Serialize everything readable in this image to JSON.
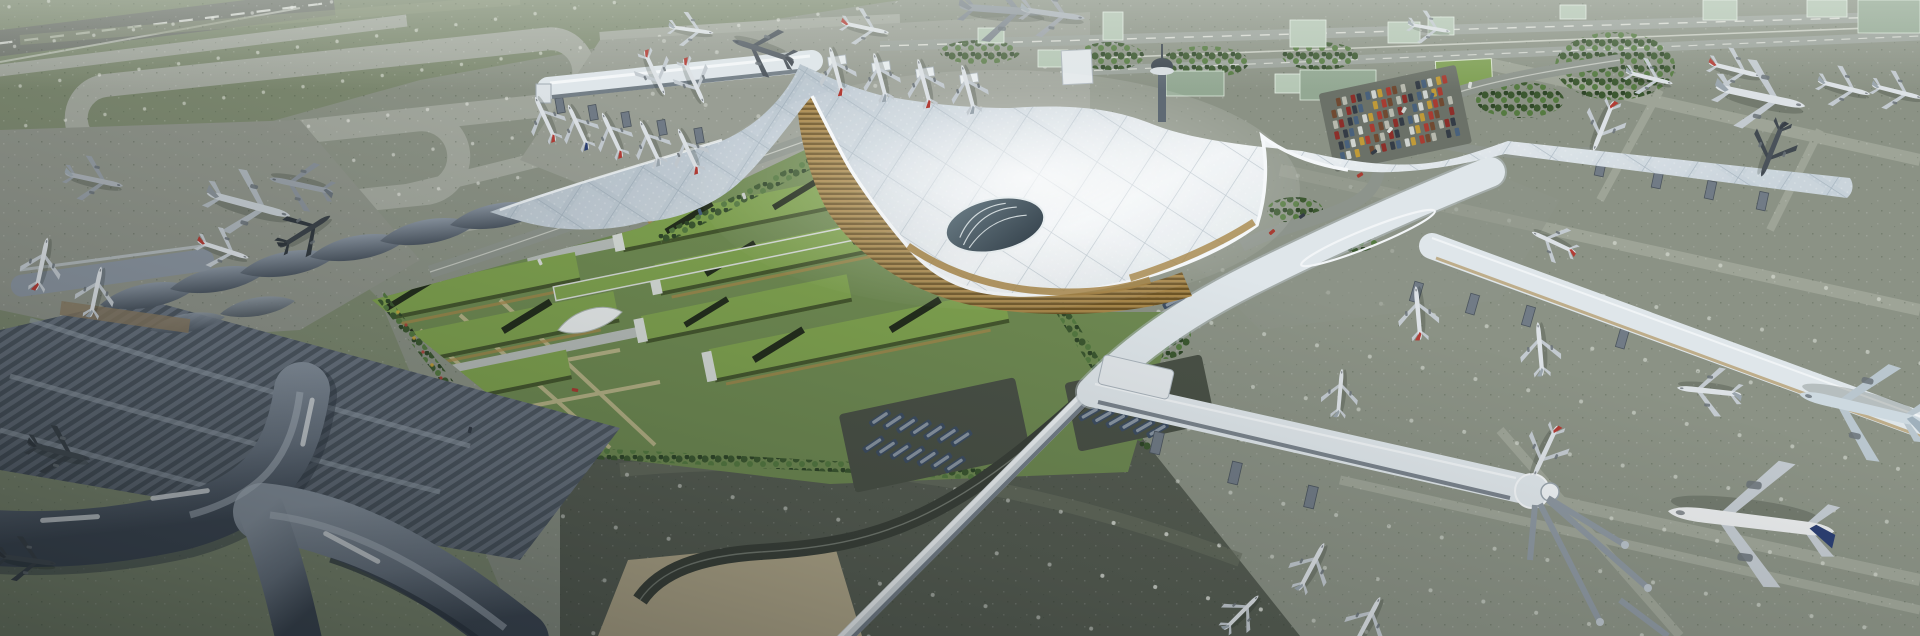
{
  "scene": {
    "subject": "aerial-render-airport-terminal-complex",
    "elements": [
      "main-terminal-gridshell-roof",
      "green-roof-district",
      "legacy-terminal-wave-halls",
      "satellite-x-pier",
      "north-concourse",
      "east-piers",
      "taxiway-loops",
      "runway",
      "landside-highway",
      "parking-lot",
      "control-tower",
      "airplanes",
      "buses",
      "cars",
      "tree-belts",
      "glass-buildings"
    ]
  },
  "colors": {
    "grass": "#7d8970",
    "grassLight": "#8b9679",
    "grassDark": "#6c785f",
    "taxiway": "#a3a89e",
    "runway": "#6f746c",
    "apronNW": "#999e94",
    "apronW": "#8f948a",
    "apronE": "#8d9387",
    "apronS": "#565d52",
    "roofHi": "#eef2f4",
    "roofMid": "#c5d0d8",
    "roofLo": "#9fadb9",
    "ribbon": "#dfe6ea",
    "spine": "#aeb9c1",
    "facadeDark": "#616c76",
    "gold": "#a8874a",
    "goldDark": "#6e5526",
    "glassCanyon": "#33404a",
    "greenRoof": "#7fa24f",
    "greenRoofDk": "#5b7737",
    "skylight": "#232d1c",
    "endcap": "#d6dbd7",
    "lawn": "#6f8a52",
    "lawnPath": "#c2b98f",
    "tree": "#3c5830",
    "treeLight": "#557a41",
    "shedHi": "#9aa5b1",
    "shedMid": "#6b7683",
    "shedLo": "#4d5762",
    "xpier": "#7e8894",
    "xpierDk": "#39424e",
    "plaza": "#b2a88a",
    "roadDark": "#3b4139",
    "roadMid": "#8d948c",
    "glassBldg": "#b5c7b5",
    "glassBldgSide": "#93a893",
    "pitch": "#7fa054",
    "towerBody": "#5f6a74",
    "planeBody": "#dde2e6",
    "planeWing": "#c3cad0",
    "tailRed": "#b23c35",
    "tailBlue": "#2c3f72",
    "bus": "#3e4e62",
    "busLight": "#93a0ac",
    "lightDot": "#f2f5ef",
    "white": "#f4f7f9",
    "shadow": "#0a1014"
  },
  "planes": [
    {
      "x": 250,
      "y": 205,
      "r": 15,
      "s": 0.8,
      "b": "#c6cdd2",
      "w": "#aeb6bc",
      "t": "#8a9298"
    },
    {
      "x": 306,
      "y": 231,
      "r": -32,
      "s": 0.55,
      "b": "#3c4349",
      "w": "#333a40",
      "t": "#30373d"
    },
    {
      "x": 224,
      "y": 250,
      "r": 18,
      "s": 0.5,
      "t": "#b23c35"
    },
    {
      "x": 42,
      "y": 263,
      "r": -78,
      "s": 0.5,
      "t": "#b23c35"
    },
    {
      "x": 96,
      "y": 291,
      "r": -78,
      "s": 0.48
    },
    {
      "x": 95,
      "y": 180,
      "r": 12,
      "s": 0.55,
      "b": "#aab1b7",
      "w": "#959da4"
    },
    {
      "x": 300,
      "y": 185,
      "r": 192,
      "s": 0.6,
      "b": "#9aa2a9",
      "w": "#8a929a",
      "t": "#6a737b"
    },
    {
      "x": 60,
      "y": 452,
      "r": 14,
      "s": 0.6,
      "b": "#454d54",
      "w": "#3c444b",
      "t": "#343b42"
    },
    {
      "x": 28,
      "y": 560,
      "r": 8,
      "s": 0.55,
      "b": "#454d54",
      "w": "#3c444b",
      "t": "#343b42"
    },
    {
      "x": 545,
      "y": 118,
      "r": -115,
      "s": 0.45,
      "t": "#b23c35"
    },
    {
      "x": 578,
      "y": 126,
      "r": -115,
      "s": 0.45,
      "t": "#2c3f72"
    },
    {
      "x": 612,
      "y": 134,
      "r": -115,
      "s": 0.45,
      "t": "#b23c35"
    },
    {
      "x": 650,
      "y": 142,
      "r": -115,
      "s": 0.45
    },
    {
      "x": 688,
      "y": 150,
      "r": -115,
      "s": 0.45,
      "t": "#b23c35"
    },
    {
      "x": 655,
      "y": 74,
      "r": 65,
      "s": 0.45,
      "t": "#b23c35"
    },
    {
      "x": 694,
      "y": 82,
      "r": 65,
      "s": 0.45,
      "t": "#b23c35"
    },
    {
      "x": 836,
      "y": 70,
      "r": -105,
      "s": 0.46,
      "t": "#b23c35"
    },
    {
      "x": 880,
      "y": 76,
      "r": -105,
      "s": 0.46
    },
    {
      "x": 924,
      "y": 82,
      "r": -105,
      "s": 0.46,
      "t": "#b23c35"
    },
    {
      "x": 968,
      "y": 88,
      "r": -105,
      "s": 0.46
    },
    {
      "x": 692,
      "y": 30,
      "r": 8,
      "s": 0.42
    },
    {
      "x": 762,
      "y": 50,
      "r": 198,
      "s": 0.6,
      "b": "#565e66",
      "w": "#4c545c",
      "t": "#454c54"
    },
    {
      "x": 866,
      "y": 28,
      "r": 12,
      "s": 0.45,
      "t": "#b23c35"
    },
    {
      "x": 1004,
      "y": 10,
      "r": 4,
      "s": 0.8,
      "b": "#8d959c",
      "w": "#7d858d",
      "t": "#767e86"
    },
    {
      "x": 1054,
      "y": 14,
      "r": 8,
      "s": 0.6,
      "b": "#aab1b8",
      "w": "#999fa6"
    },
    {
      "x": 1430,
      "y": 28,
      "r": 10,
      "s": 0.4
    },
    {
      "x": 1650,
      "y": 78,
      "r": 14,
      "s": 0.45
    },
    {
      "x": 1736,
      "y": 70,
      "r": 14,
      "s": 0.5,
      "t": "#b23c35"
    },
    {
      "x": 1762,
      "y": 97,
      "r": 12,
      "s": 0.85
    },
    {
      "x": 1845,
      "y": 88,
      "r": 14,
      "s": 0.5
    },
    {
      "x": 1898,
      "y": 92,
      "r": 14,
      "s": 0.48
    },
    {
      "x": 1603,
      "y": 127,
      "r": 112,
      "s": 0.5,
      "t": "#b23c35"
    },
    {
      "x": 1772,
      "y": 150,
      "r": 112,
      "s": 0.55,
      "b": "#4a525a",
      "w": "#414950",
      "t": "#394048"
    },
    {
      "x": 1553,
      "y": 242,
      "r": 205,
      "s": 0.45,
      "t": "#b23c35"
    },
    {
      "x": 1418,
      "y": 312,
      "r": -95,
      "s": 0.5,
      "t": "#b23c35"
    },
    {
      "x": 1540,
      "y": 348,
      "r": -95,
      "s": 0.5
    },
    {
      "x": 1340,
      "y": 392,
      "r": -85,
      "s": 0.45
    },
    {
      "x": 1545,
      "y": 452,
      "r": 115,
      "s": 0.52,
      "t": "#b23c35"
    },
    {
      "x": 1312,
      "y": 566,
      "r": -62,
      "s": 0.5
    },
    {
      "x": 1368,
      "y": 620,
      "r": -62,
      "s": 0.5
    },
    {
      "x": 1242,
      "y": 612,
      "r": -45,
      "s": 0.45
    },
    {
      "x": 1748,
      "y": 521,
      "r": 187,
      "s": 1.55,
      "b": "#e9ebec",
      "t": "#2c3f72"
    },
    {
      "x": 1860,
      "y": 408,
      "r": 193,
      "s": 1.2,
      "b": "#cdd9e0",
      "w": "#b9c6ce",
      "t": "#9fb0bc"
    },
    {
      "x": 1708,
      "y": 391,
      "r": 186,
      "s": 0.6
    }
  ],
  "carpark": {
    "x": 1328,
    "y": 100,
    "rot": -12,
    "rows": 6,
    "cols": 17,
    "gx": 7.3,
    "gy": 10.8,
    "w": 4.6,
    "h": 8.2
  },
  "carColors": [
    "#a83c32",
    "#c09a38",
    "#cfd3cf",
    "#49617c",
    "#343c46",
    "#8c2f2a",
    "#b7b9ae",
    "#704a32"
  ],
  "busLots": [
    {
      "x": 880,
      "y": 418,
      "rowAng": 14,
      "busAng": -34,
      "n": 7,
      "rows": 2,
      "gap": 14,
      "dy": 27
    },
    {
      "x": 1096,
      "y": 388,
      "rowAng": 14,
      "busAng": -30,
      "n": 6,
      "rows": 2,
      "gap": 14,
      "dy": 26
    },
    {
      "x": 1136,
      "y": 292,
      "rowAng": 14,
      "busAng": -28,
      "n": 5,
      "rows": 1,
      "gap": 13,
      "dy": 0
    }
  ],
  "roadCars": [
    {
      "x": 1390,
      "y": 130,
      "r": 40
    },
    {
      "x": 1374,
      "y": 152,
      "r": 55
    },
    {
      "x": 1360,
      "y": 175,
      "r": 60
    },
    {
      "x": 1404,
      "y": 110,
      "r": 30
    },
    {
      "x": 1432,
      "y": 96,
      "r": 20
    },
    {
      "x": 1470,
      "y": 85,
      "r": 12
    },
    {
      "x": 1302,
      "y": 216,
      "r": 55
    },
    {
      "x": 1272,
      "y": 232,
      "r": 50
    },
    {
      "x": 744,
      "y": 196,
      "r": -20
    },
    {
      "x": 700,
      "y": 212,
      "r": -20
    },
    {
      "x": 540,
      "y": 262,
      "r": -25
    },
    {
      "x": 470,
      "y": 430,
      "r": 15
    },
    {
      "x": 575,
      "y": 390,
      "r": -80
    }
  ]
}
